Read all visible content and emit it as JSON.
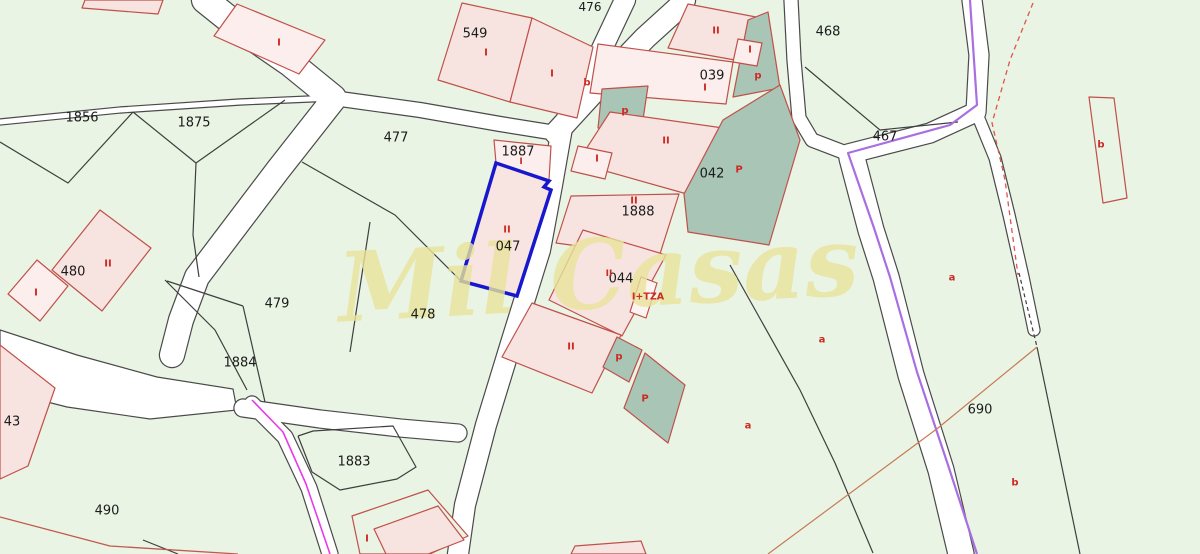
{
  "canvas": {
    "width": 1200,
    "height": 554
  },
  "watermark": {
    "text": "Mil Casas",
    "x": 600,
    "y": 308,
    "size": 96,
    "rotate": -3,
    "color": "#e9e39b",
    "opacity": 0.8
  },
  "colors": {
    "bg": "#e9f4e4",
    "road_fill": "#ffffff",
    "road_edge": "#4a4a4a",
    "boundary": "#3f3f3f",
    "pink": "#f7e4e1",
    "pale": "#fbeeec",
    "light": "#fdf4f2",
    "green": "#e9f4e4",
    "none": "none",
    "building_stroke": "#c0504a",
    "teal": "#a8c5b5",
    "selected_stroke": "#1717cd",
    "selected_fill": "#f8e5e2",
    "purple": "#a96fe0",
    "magenta": "#e83ae8",
    "red_dash": "#e05548",
    "ochre": "#c87a55",
    "red_brown": "#c4584e",
    "label": "#1b1b1b",
    "code": "#cc2b24"
  },
  "map": {
    "plaza": "0,330 77,355 157,377 233,389 237,410 150,419 67,407 0,390",
    "roads": [
      {
        "name": "road-top-left-entry",
        "pts": "205,0 245,32 290,63 333,98",
        "w": 26
      },
      {
        "name": "road-west-thin",
        "pts": "0,122 120,110 240,102 333,98",
        "w": 5
      },
      {
        "name": "road-west-descending",
        "pts": "333,100 278,170 225,240 197,277 181,320 172,355",
        "w": 24
      },
      {
        "name": "road-477-north",
        "pts": "333,98 420,110 500,124 556,133",
        "w": 14
      },
      {
        "name": "road-central-main",
        "pts": "625,0 592,70 562,128 552,185 540,250 512,340 486,425 465,505 458,554",
        "w": 20
      },
      {
        "name": "road-northeast-branch",
        "pts": "556,133 600,85 645,38 678,8 684,0",
        "w": 22
      },
      {
        "name": "road-039-east",
        "pts": "791,0 794,60 799,118 812,140 846,153",
        "w": 13
      },
      {
        "name": "road-topright-bend",
        "pts": "972,0 979,55 976,112 930,133 848,154",
        "w": 19
      },
      {
        "name": "road-right-descending",
        "pts": "852,158 871,230 886,277 911,375 941,470 961,554",
        "w": 25
      },
      {
        "name": "road-southeast-spur",
        "pts": "977,114 995,158 1009,215 1023,277 1034,330",
        "w": 11
      },
      {
        "name": "road-1883-north",
        "pts": "243,408 320,419 400,428 458,433",
        "w": 17
      },
      {
        "name": "road-southwest",
        "pts": "252,404 285,437 309,488 330,554",
        "w": 15
      }
    ],
    "boundaries": [
      {
        "pts": "0,142 68,183 133,112"
      },
      {
        "pts": "133,112 196,163 285,100"
      },
      {
        "pts": "196,163 193,235 199,277"
      },
      {
        "pts": "302,162 395,215 461,281"
      },
      {
        "pts": "370,222 358,300 350,352"
      },
      {
        "pts": "165,280 215,330 247,390"
      },
      {
        "pts": "167,281 243,306"
      },
      {
        "pts": "243,306 265,402"
      },
      {
        "pts": "298,436 313,431 393,426 416,467 397,479 340,490 312,472 298,436"
      },
      {
        "pts": "805,67 880,130 958,122"
      },
      {
        "pts": "730,265 800,390 835,463 873,553"
      },
      {
        "pts": "1019,273 1037,347",
        "dash": "4 3"
      },
      {
        "pts": "1037,347 1080,554"
      },
      {
        "pts": "143,540 178,554"
      }
    ],
    "special_lines": [
      {
        "name": "purple-boundary-line",
        "color": "purple",
        "w": 2.2,
        "pts": "970,0 977,105 950,125 848,153 874,228 890,277 917,372 948,465 977,554"
      },
      {
        "name": "magenta-boundary-line",
        "color": "magenta",
        "w": 1.6,
        "pts": "252,400 283,432 306,484 330,554"
      },
      {
        "name": "red-dashed-line",
        "color": "red_dash",
        "w": 1.3,
        "dash": "5 4",
        "pts": "1033,3 1010,60 992,123 1005,180 1018,275"
      },
      {
        "name": "ochre-boundary-line",
        "color": "ochre",
        "w": 1.2,
        "pts": "1037,347 938,428 768,554"
      },
      {
        "name": "red-brown-corner-line",
        "color": "red_brown",
        "w": 1.3,
        "pts": "0,517 110,546 238,554"
      }
    ],
    "buildings": [
      {
        "name": "building-top-edge",
        "fill": "pink",
        "pts": "85,0 163,0 158,14 82,8"
      },
      {
        "name": "building-topleft-I",
        "fill": "pale",
        "pts": "237,4 325,40 299,74 214,36"
      },
      {
        "name": "building-549-west",
        "fill": "pink",
        "pts": "462,3 532,18 510,102 438,80"
      },
      {
        "name": "building-549-east",
        "fill": "pink",
        "pts": "532,18 593,47 577,118 510,102"
      },
      {
        "name": "building-1887",
        "fill": "pale",
        "pts": "494,140 551,146 549,180 496,163"
      },
      {
        "name": "building-039-north",
        "fill": "pink",
        "pts": "688,4 756,17 746,62 668,48"
      },
      {
        "name": "teal-area-039-east",
        "fill": "teal",
        "pts": "748,20 768,12 780,88 733,97"
      },
      {
        "name": "building-039-small-I",
        "fill": "pale",
        "pts": "738,39 762,43 757,66 733,62"
      },
      {
        "name": "building-039-main",
        "fill": "pale",
        "pts": "598,44 733,62 726,104 590,93"
      },
      {
        "name": "teal-area-west",
        "fill": "teal",
        "pts": "602,89 648,86 641,133 598,128"
      },
      {
        "name": "building-II-upper",
        "fill": "pink",
        "pts": "610,112 723,128 687,194 577,163"
      },
      {
        "name": "teal-area-042",
        "fill": "teal",
        "pts": "723,120 780,85 800,140 769,245 688,232 684,194"
      },
      {
        "name": "building-small-I-mid",
        "fill": "pale",
        "pts": "578,146 612,153 605,179 571,171"
      },
      {
        "name": "building-1888",
        "fill": "pink",
        "pts": "571,196 679,194 659,257 556,243"
      },
      {
        "name": "building-044",
        "fill": "pink",
        "pts": "583,230 666,255 622,336 549,300"
      },
      {
        "name": "building-tza-annex",
        "fill": "light",
        "pts": "641,277 657,283 646,318 630,312"
      },
      {
        "name": "building-II-south",
        "fill": "pink",
        "pts": "532,303 621,335 592,393 502,357"
      },
      {
        "name": "teal-area-south-small",
        "fill": "teal",
        "pts": "617,337 642,350 629,382 603,367"
      },
      {
        "name": "teal-area-south-large",
        "fill": "teal",
        "pts": "645,353 685,385 668,443 624,408"
      },
      {
        "name": "building-480-II",
        "fill": "pink",
        "pts": "100,210 151,248 102,311 52,270"
      },
      {
        "name": "building-480-I",
        "fill": "pale",
        "pts": "37,260 68,286 40,321 8,294"
      },
      {
        "name": "parcel-43-pink",
        "fill": "pink",
        "pts": "0,345 55,388 28,466 0,479"
      },
      {
        "name": "parcel-bottom-green",
        "fill": "green",
        "pts": "352,516 428,490 468,536 430,554 360,554"
      },
      {
        "name": "building-bottom-house",
        "fill": "pink",
        "pts": "374,529 438,506 464,540 428,554 386,554"
      },
      {
        "name": "building-bottom-sliver",
        "fill": "pink",
        "pts": "575,546 641,541 646,554 571,554"
      },
      {
        "name": "outline-b-rect-topright",
        "fill": "none",
        "pts": "1089,97 1114,98 1127,198 1103,203"
      }
    ],
    "selected_parcel": {
      "name": "selected-parcel-047-outline",
      "pts": "496,163 549,181 544,187 551,190 517,296 461,281"
    },
    "parcel_labels": [
      {
        "text": "1856",
        "x": 82,
        "y": 118
      },
      {
        "text": "1875",
        "x": 194,
        "y": 123
      },
      {
        "text": "549",
        "x": 475,
        "y": 34
      },
      {
        "text": "476",
        "x": 590,
        "y": 7,
        "size": 12
      },
      {
        "text": "477",
        "x": 396,
        "y": 138
      },
      {
        "text": "1887",
        "x": 518,
        "y": 152
      },
      {
        "text": "039",
        "x": 712,
        "y": 76
      },
      {
        "text": "468",
        "x": 828,
        "y": 32
      },
      {
        "text": "467",
        "x": 885,
        "y": 137
      },
      {
        "text": "042",
        "x": 712,
        "y": 174
      },
      {
        "text": "1888",
        "x": 638,
        "y": 212
      },
      {
        "text": "047",
        "x": 508,
        "y": 247
      },
      {
        "text": "044",
        "x": 621,
        "y": 279
      },
      {
        "text": "480",
        "x": 73,
        "y": 272
      },
      {
        "text": "479",
        "x": 277,
        "y": 304
      },
      {
        "text": "478",
        "x": 423,
        "y": 315
      },
      {
        "text": "1884",
        "x": 240,
        "y": 363
      },
      {
        "text": "1883",
        "x": 354,
        "y": 462
      },
      {
        "text": "490",
        "x": 107,
        "y": 511
      },
      {
        "text": "690",
        "x": 980,
        "y": 410
      },
      {
        "text": "43",
        "x": 12,
        "y": 422
      }
    ],
    "code_labels": [
      {
        "text": "I",
        "x": 279,
        "y": 43
      },
      {
        "text": "I",
        "x": 486,
        "y": 53
      },
      {
        "text": "I",
        "x": 552,
        "y": 74
      },
      {
        "text": "b",
        "x": 587,
        "y": 83
      },
      {
        "text": "II",
        "x": 716,
        "y": 31
      },
      {
        "text": "I",
        "x": 750,
        "y": 50
      },
      {
        "text": "p",
        "x": 758,
        "y": 76
      },
      {
        "text": "I",
        "x": 705,
        "y": 88
      },
      {
        "text": "p",
        "x": 625,
        "y": 111
      },
      {
        "text": "II",
        "x": 666,
        "y": 141
      },
      {
        "text": "I",
        "x": 597,
        "y": 159
      },
      {
        "text": "P",
        "x": 739,
        "y": 170
      },
      {
        "text": "II",
        "x": 634,
        "y": 201
      },
      {
        "text": "I",
        "x": 521,
        "y": 162,
        "size": 9
      },
      {
        "text": "II",
        "x": 507,
        "y": 230
      },
      {
        "text": "II",
        "x": 609,
        "y": 274,
        "size": 9
      },
      {
        "text": "I+TZA",
        "x": 648,
        "y": 297,
        "size": 9.5
      },
      {
        "text": "II",
        "x": 571,
        "y": 347
      },
      {
        "text": "p",
        "x": 619,
        "y": 357
      },
      {
        "text": "P",
        "x": 645,
        "y": 399
      },
      {
        "text": "II",
        "x": 108,
        "y": 264
      },
      {
        "text": "I",
        "x": 36,
        "y": 293
      },
      {
        "text": "I",
        "x": 367,
        "y": 539
      },
      {
        "text": "a",
        "x": 952,
        "y": 278
      },
      {
        "text": "a",
        "x": 822,
        "y": 340
      },
      {
        "text": "a",
        "x": 748,
        "y": 426
      },
      {
        "text": "b",
        "x": 1101,
        "y": 145
      },
      {
        "text": "b",
        "x": 1015,
        "y": 483
      }
    ]
  }
}
